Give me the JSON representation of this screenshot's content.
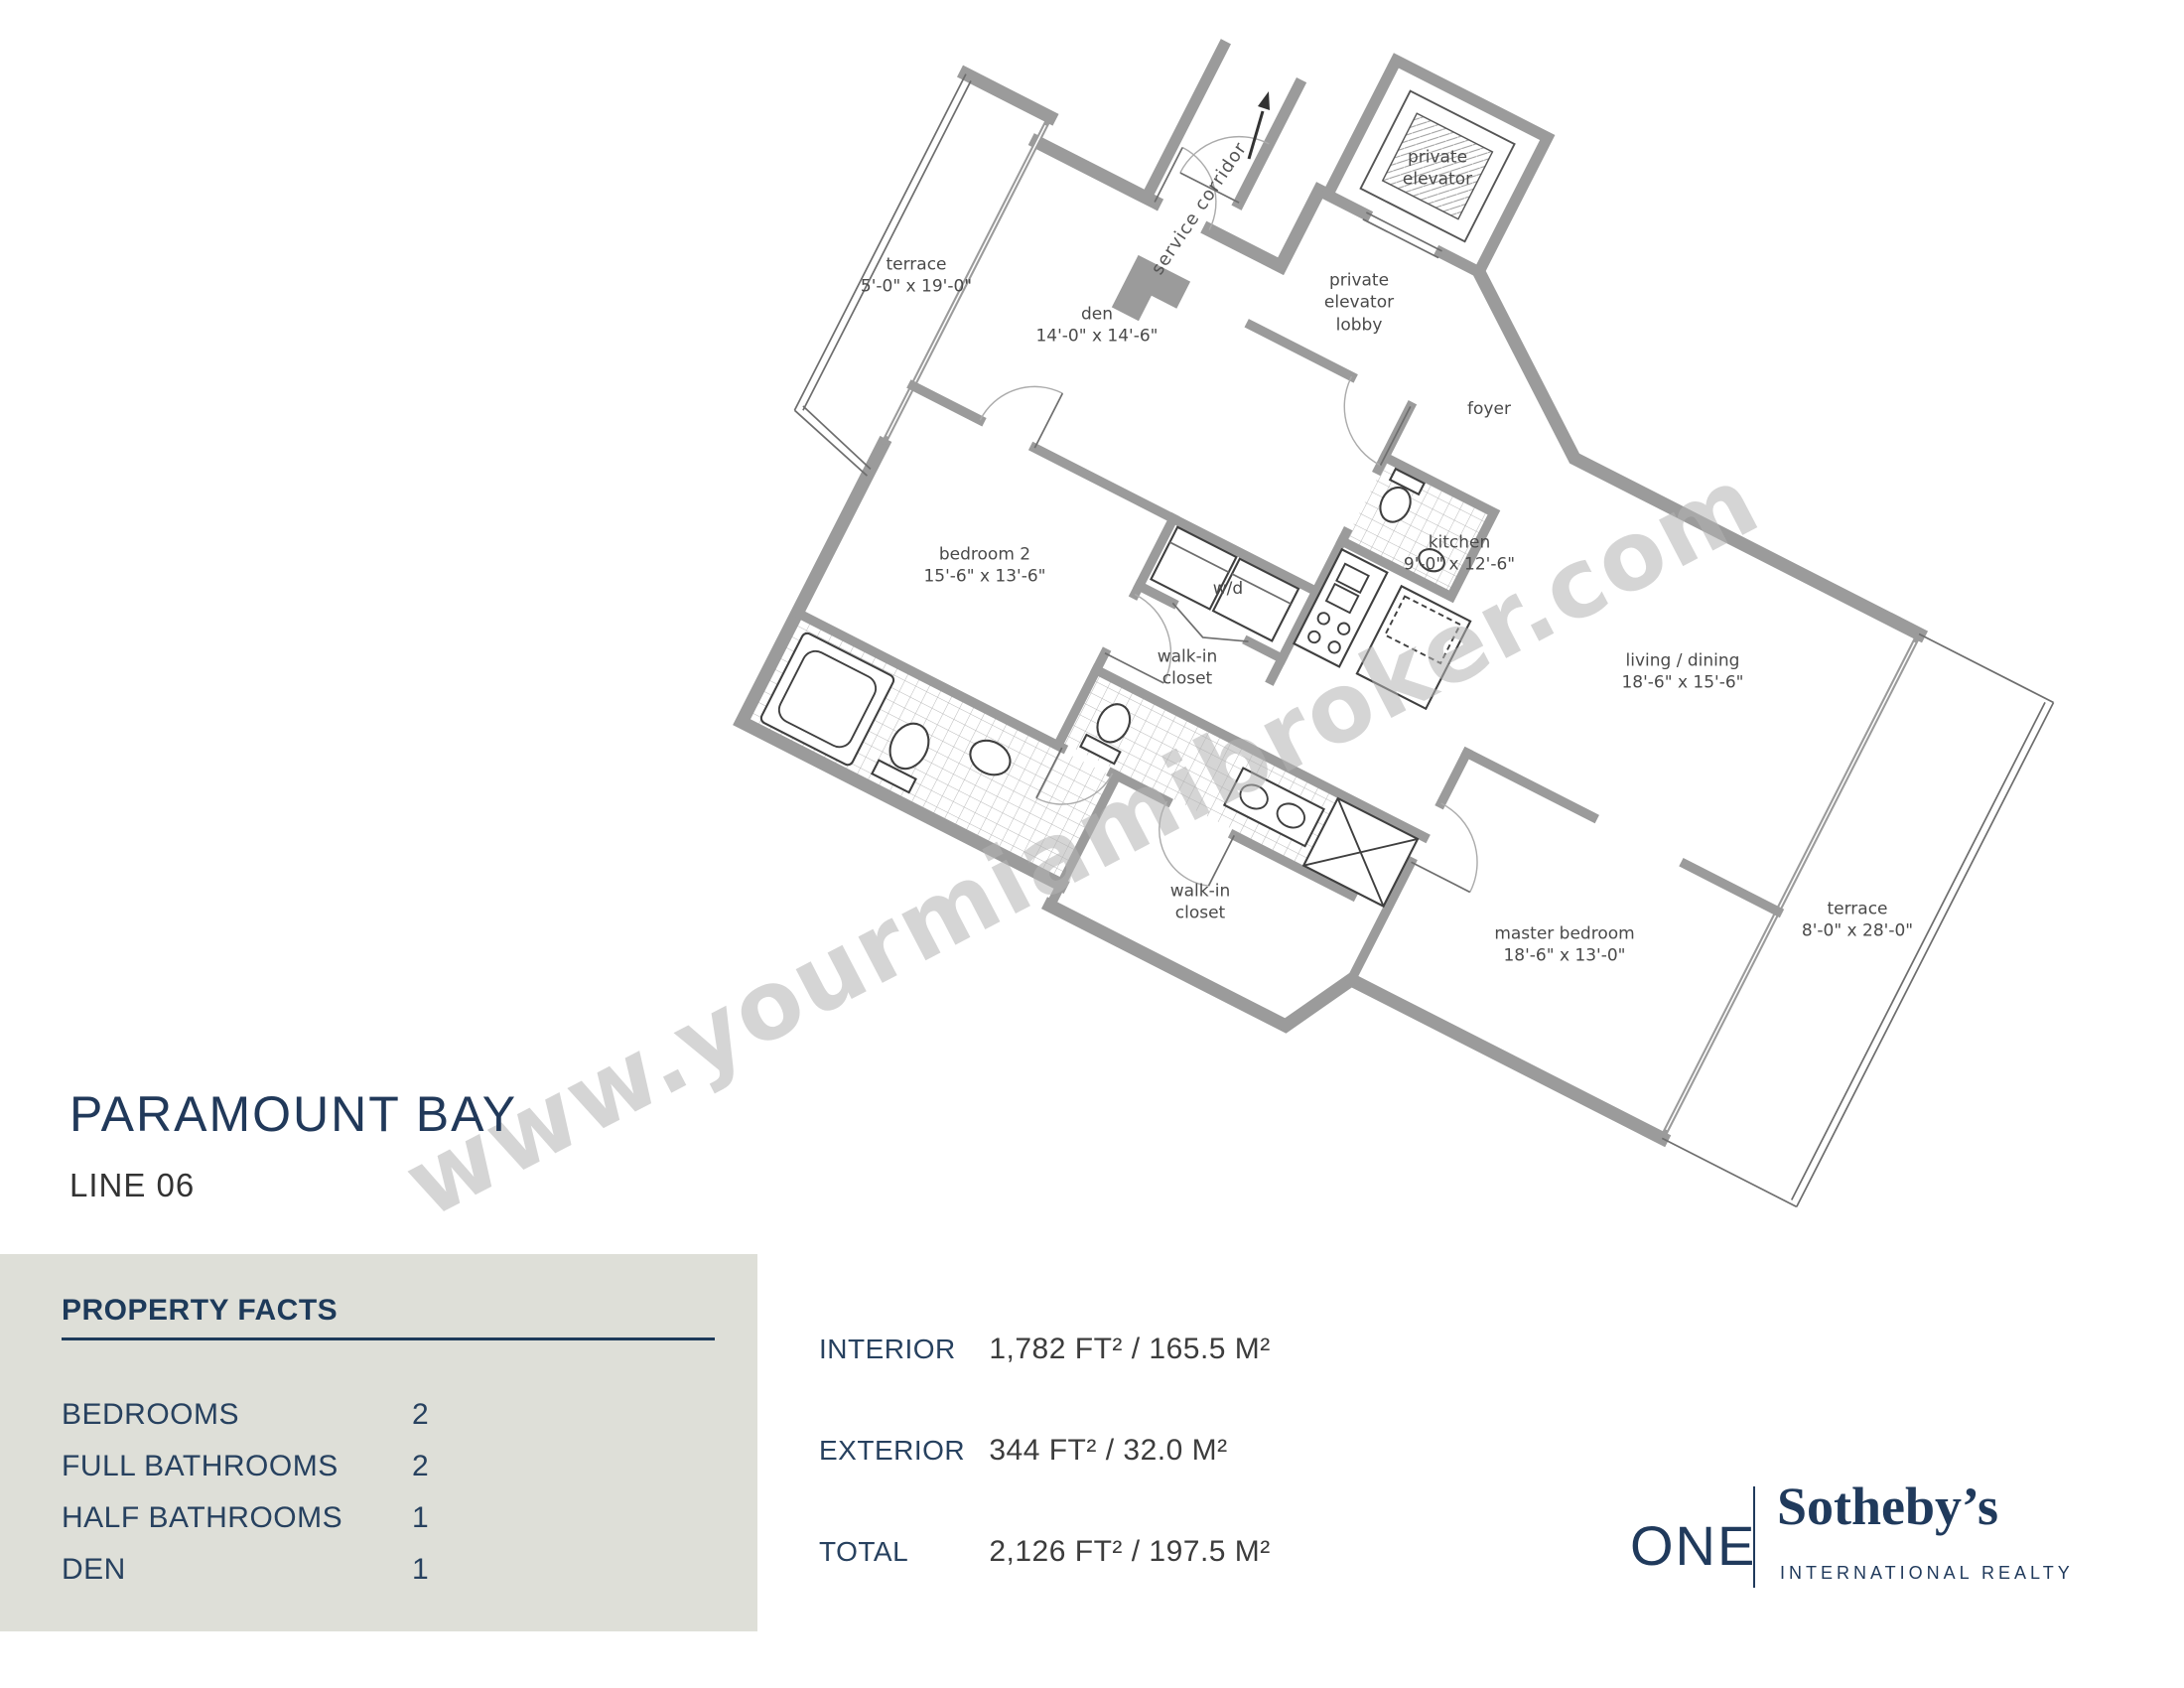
{
  "watermark": {
    "text": "www.yourmiamibroker.com",
    "color": "#b4b4b4"
  },
  "title": {
    "building": "PARAMOUNT BAY",
    "line": "LINE 06"
  },
  "floor_plan": {
    "service_corridor_label": "service corridor",
    "rooms": [
      {
        "id": "terrace-left",
        "lines": [
          "terrace",
          "5'-0\" x 19'-0\""
        ]
      },
      {
        "id": "den",
        "lines": [
          "den",
          "14'-0\" x 14'-6\""
        ]
      },
      {
        "id": "bedroom-2",
        "lines": [
          "bedroom 2",
          "15'-6\" x 13'-6\""
        ]
      },
      {
        "id": "private-elevator",
        "lines": [
          "private",
          "elevator"
        ]
      },
      {
        "id": "private-elevator-lobby",
        "lines": [
          "private",
          "elevator",
          "lobby"
        ]
      },
      {
        "id": "foyer",
        "lines": [
          "foyer"
        ]
      },
      {
        "id": "kitchen",
        "lines": [
          "kitchen",
          "9'-0\" x 12'-6\""
        ]
      },
      {
        "id": "washer-dryer",
        "lines": [
          "w/d"
        ]
      },
      {
        "id": "walk-in-closet-1",
        "lines": [
          "walk-in",
          "closet"
        ]
      },
      {
        "id": "walk-in-closet-2",
        "lines": [
          "walk-in",
          "closet"
        ]
      },
      {
        "id": "living-dining",
        "lines": [
          "living / dining",
          "18'-6\" x 15'-6\""
        ]
      },
      {
        "id": "master-bedroom",
        "lines": [
          "master bedroom",
          "18'-6\" x 13'-0\""
        ]
      },
      {
        "id": "terrace-right",
        "lines": [
          "terrace",
          "8'-0\" x 28'-0\""
        ]
      }
    ]
  },
  "property_facts": {
    "heading": "PROPERTY FACTS",
    "rows": [
      {
        "label": "BEDROOMS",
        "value": "2"
      },
      {
        "label": "FULL BATHROOMS",
        "value": "2"
      },
      {
        "label": "HALF BATHROOMS",
        "value": "1"
      },
      {
        "label": "DEN",
        "value": "1"
      }
    ]
  },
  "areas": {
    "rows": [
      {
        "label": "INTERIOR",
        "value": "1,782 FT² / 165.5 M²"
      },
      {
        "label": "EXTERIOR",
        "value": "344 FT² / 32.0 M²"
      },
      {
        "label": "TOTAL",
        "value": "2,126 FT² / 197.5 M²"
      }
    ]
  },
  "logo": {
    "prefix": "ONE",
    "brand": "Sotheby’s",
    "subtitle": "INTERNATIONAL REALTY"
  },
  "colors": {
    "navy": "#21395a",
    "text_dark": "#3a3a3a",
    "wall_gray": "#9b9b9b",
    "panel_bg": "#dedfd8"
  }
}
